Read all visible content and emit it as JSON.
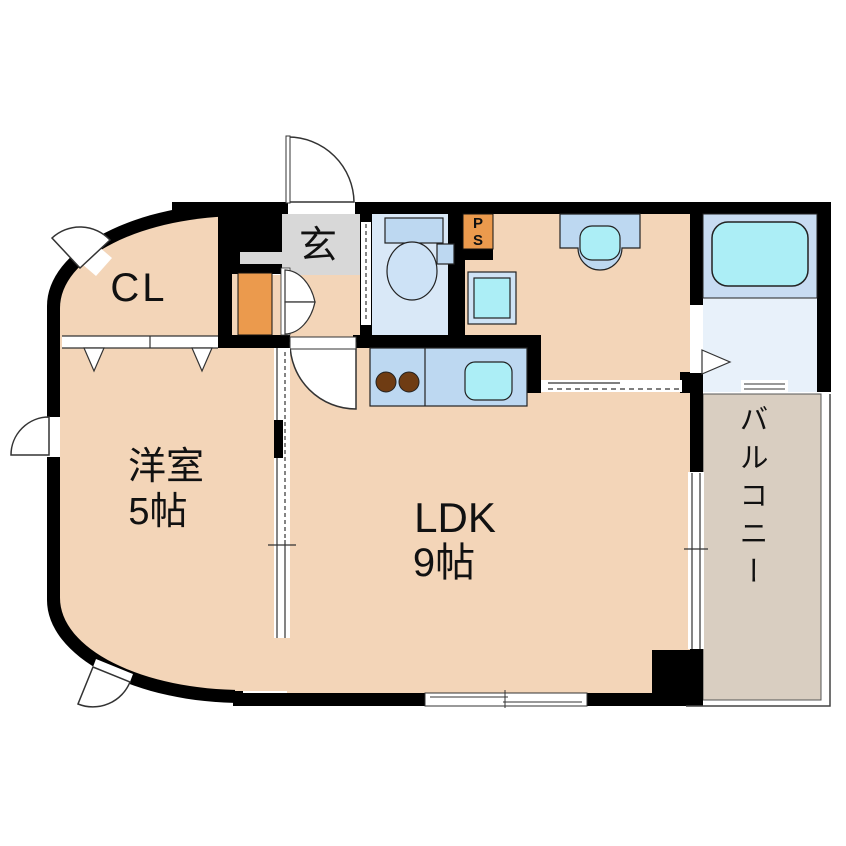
{
  "floorplan": {
    "rooms": {
      "closet": {
        "label": "CL"
      },
      "entrance": {
        "label": "玄"
      },
      "pipe_space": {
        "line1": "P",
        "line2": "S"
      },
      "western_room": {
        "name": "洋室",
        "size": "5帖"
      },
      "ldk": {
        "name": "LDK",
        "size": "9帖"
      },
      "balcony": {
        "name": "バルコニー"
      }
    },
    "colors": {
      "wall": "#000000",
      "room_floor": "#f3d5b8",
      "entrance_floor": "#d8d8d8",
      "accent_orange": "#eb9a4d",
      "toilet_floor": "#d9e8f7",
      "bath_floor": "#e8f1fa",
      "fixture_blue": "#bdd8f1",
      "fixture_cyan": "#aceef6",
      "burner_brown": "#6f3c13",
      "balcony_floor": "#d9cec1"
    },
    "fixtures": {
      "entrance_door": "swing-door",
      "hall_door": "swing-door",
      "closet_door": "folding-door",
      "shoe_cabinet": "double-door-cabinet",
      "toilet": "toilet",
      "washbasin": "vanity-basin",
      "washing_machine_pan": "washing-machine-pan",
      "kitchen": "counter-two-burners-sink",
      "bathtub": "bathtub",
      "bath_door": "folding-door-marker",
      "balcony_access": "sliding-glass-door"
    }
  }
}
